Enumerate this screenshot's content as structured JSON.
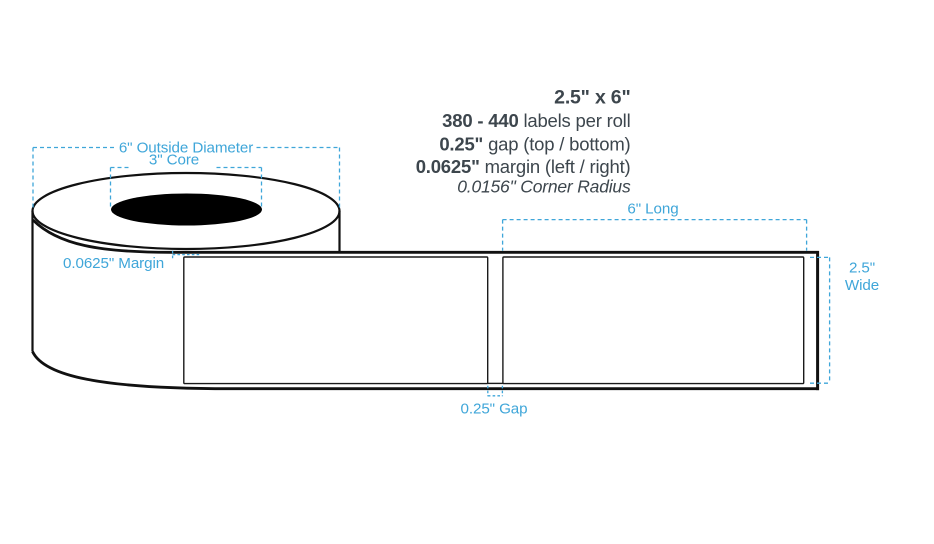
{
  "colors": {
    "accent_blue": "#3FA6D9",
    "text_dark": "#3D464D",
    "line_black": "#111111"
  },
  "specs": {
    "size_title": "2.5\" x 6\"",
    "labels_per_roll_value": "380 - 440",
    "labels_per_roll_label": " labels per roll",
    "gap_value": "0.25\"",
    "gap_label": " gap (top / bottom)",
    "margin_value": "0.0625\"",
    "margin_label": " margin (left / right)",
    "corner_radius": "0.0156\" Corner Radius"
  },
  "dimension_labels": {
    "outside_diameter": "6\" Outside Diameter",
    "core": "3\" Core",
    "roll_margin": "0.0625\" Margin",
    "label_length": "6\" Long",
    "label_width_line1": "2.5\"",
    "label_width_line2": "Wide",
    "label_gap": "0.25\" Gap"
  }
}
